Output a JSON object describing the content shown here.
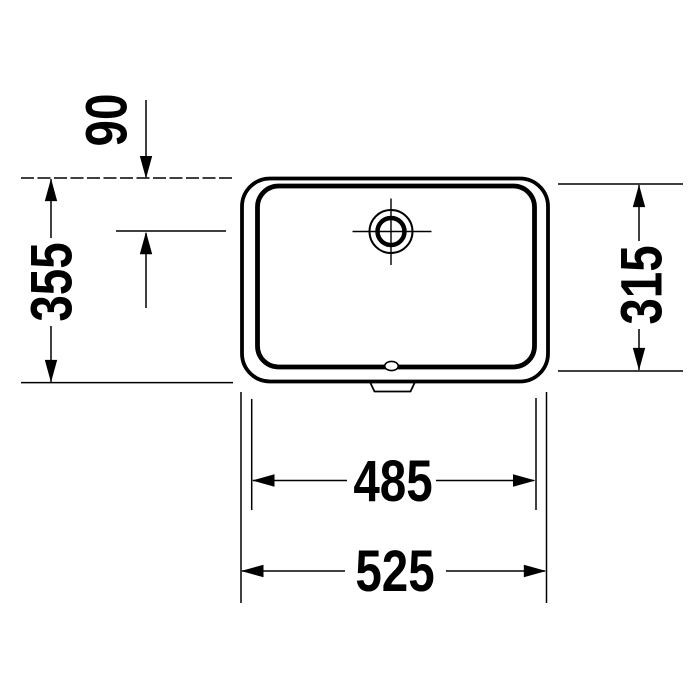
{
  "drawing": {
    "background_color": "#ffffff",
    "line_color": "#000000",
    "dimensions": {
      "drain_offset": "90",
      "overall_depth": "355",
      "basin_depth": "315",
      "basin_width": "485",
      "overall_width": "525"
    }
  }
}
